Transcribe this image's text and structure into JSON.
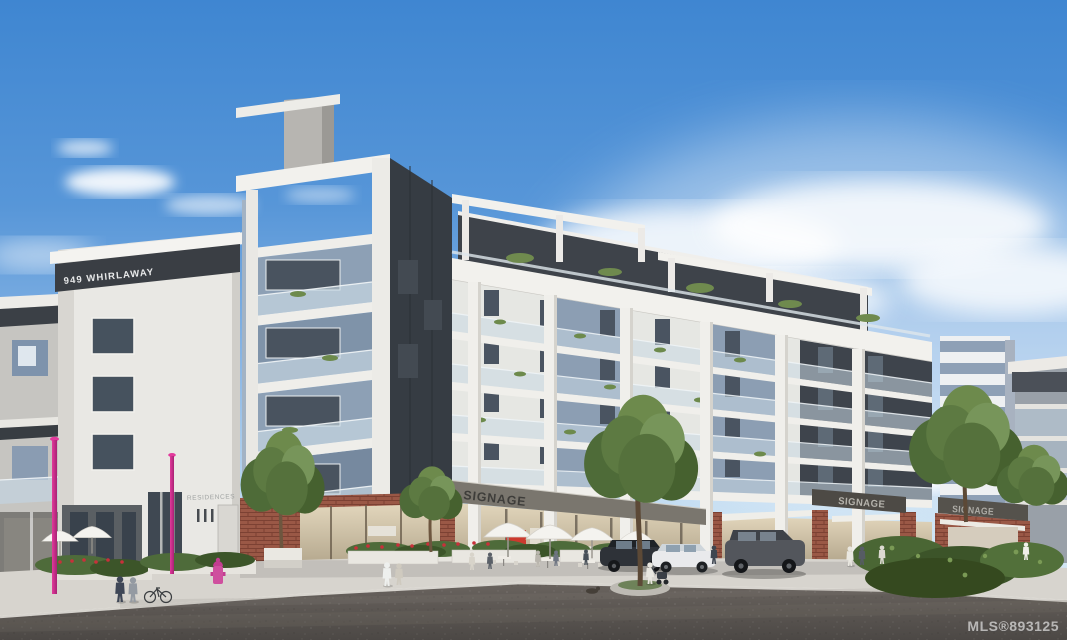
{
  "image": {
    "type": "architectural-rendering-photo",
    "subject": "Modern mixed-use condominium building with street-level retail, cafe patio, parked cars and landscaping under a blue sky",
    "signs": {
      "building_address": "949 WHIRLAWAY",
      "residences": "RESIDENCES",
      "retail_canopy": "SIGNAGE",
      "retail_board_a": "SIGNAGE",
      "retail_board_b": "SIGNAGE"
    },
    "watermark": "MLS®893125",
    "palette": {
      "sky_top": "#3f86d1",
      "sky_horizon": "#e8f2f9",
      "facade_white": "#e9e8e4",
      "facade_charcoal": "#3a3f46",
      "facade_blue_gray": "#8296ad",
      "brick": "#9a5846",
      "glass_rail": "#cadae5",
      "accent_pink": "#d63092",
      "asphalt": "#5d5855",
      "foliage": "#55713c"
    }
  }
}
